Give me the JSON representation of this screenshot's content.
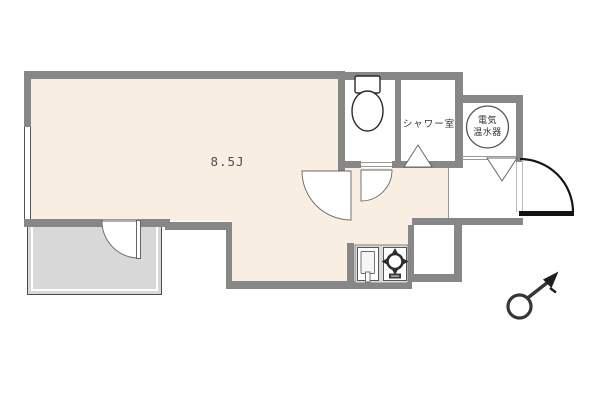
{
  "floorplan": {
    "main_room_label": "8.5J",
    "shower_room_label": "シャワー室",
    "water_heater_label_line1": "電気",
    "water_heater_label_line2": "温水器",
    "colors": {
      "room_fill": "#f9eee2",
      "wall_gray": "#878787",
      "balcony_fill": "#d8d8d8",
      "door_line": "#141414"
    }
  }
}
